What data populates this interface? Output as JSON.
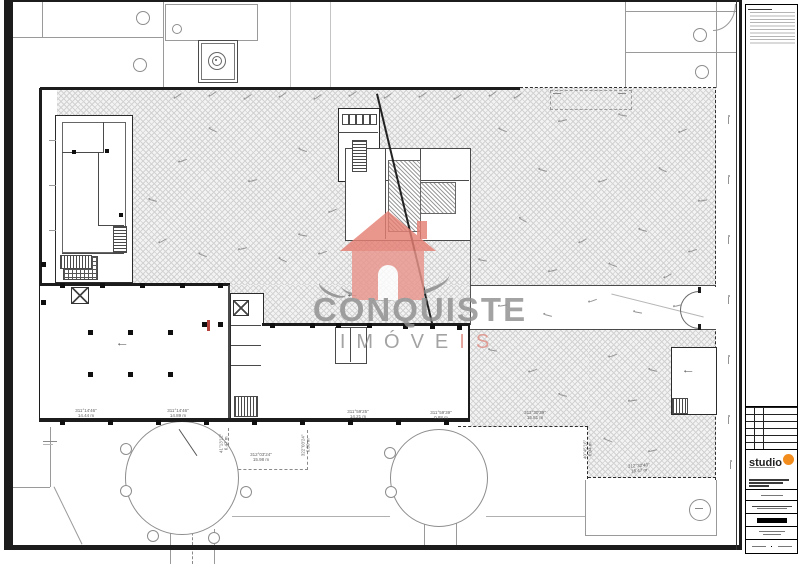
{
  "watermark": {
    "line1": "CONQUISTE",
    "line2_main": "IMÓVE",
    "line2_accent": "IS",
    "house_color": "#e9968c",
    "roof_color": "#e57f73",
    "swoosh_color": "#8a8a8a",
    "text_color": "#8f8f8f"
  },
  "title_block": {
    "logo_text": "studio",
    "logo_dot_color": "#f28c1c"
  },
  "dims": {
    "d1a": "311°14'46\"",
    "d1b": "14.44 m",
    "d2a": "311°14'46\"",
    "d2b": "14.89 m",
    "d3a": "311°59'25\"",
    "d3b": "14.21 m",
    "d4a": "311°59'39\"",
    "d4b": "0.88 m",
    "d5a": "312°30'39\"",
    "d5b": "15.81 m",
    "d6a": "40°45'16\"",
    "d6b": "6.04 m",
    "d7a": "312°32'40\"",
    "d7b": "16.47 m",
    "d8a": "41°13'12\"",
    "d8b": "6.47 m",
    "d9a": "312°03'24\"",
    "d9b": "15.98 m",
    "d10a": "322°03'24\"",
    "d10b": "6.80 m"
  }
}
